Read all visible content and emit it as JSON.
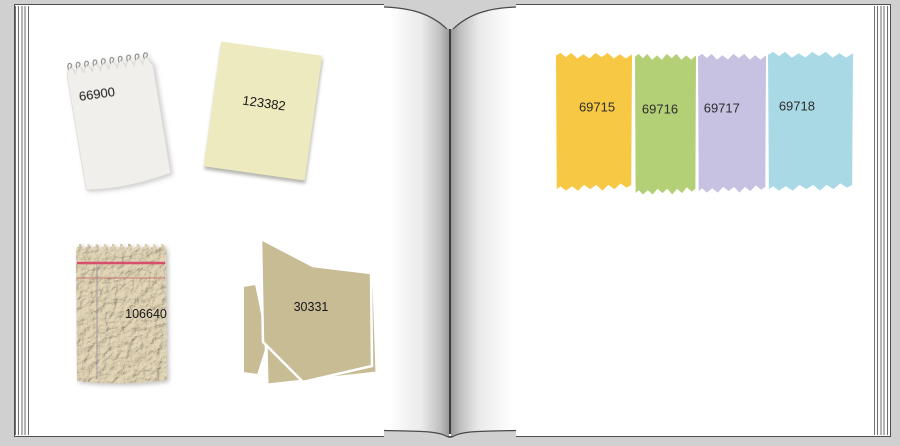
{
  "book": {
    "left_page": {
      "items": [
        {
          "name": "white-notepad",
          "label": "66900"
        },
        {
          "name": "cream-paper",
          "label": "123382"
        },
        {
          "name": "tan-notepad",
          "label": "106640"
        },
        {
          "name": "paper-stack",
          "label": "30331"
        }
      ]
    },
    "right_page": {
      "strips": [
        {
          "label": "69715",
          "color": "#f7c843"
        },
        {
          "label": "69716",
          "color": "#b3d077"
        },
        {
          "label": "69717",
          "color": "#c7c2e1"
        },
        {
          "label": "69718",
          "color": "#a9d9e5"
        }
      ]
    }
  },
  "colors": {
    "outer_background": "#d1d0d1",
    "page": "#ffffff",
    "spine_line": "#3d3c3c",
    "white_pad_paper": "#f1efeb",
    "cream_paper": "#edeabf",
    "tan_texture_paper": "#d9cbab",
    "tan_sheet": "#c8bc95",
    "red_rule_thick": "#d84e6d",
    "red_rule_thin": "#c96a6a",
    "margin_rule": "#9b8fa0",
    "number_text": "#161616"
  }
}
